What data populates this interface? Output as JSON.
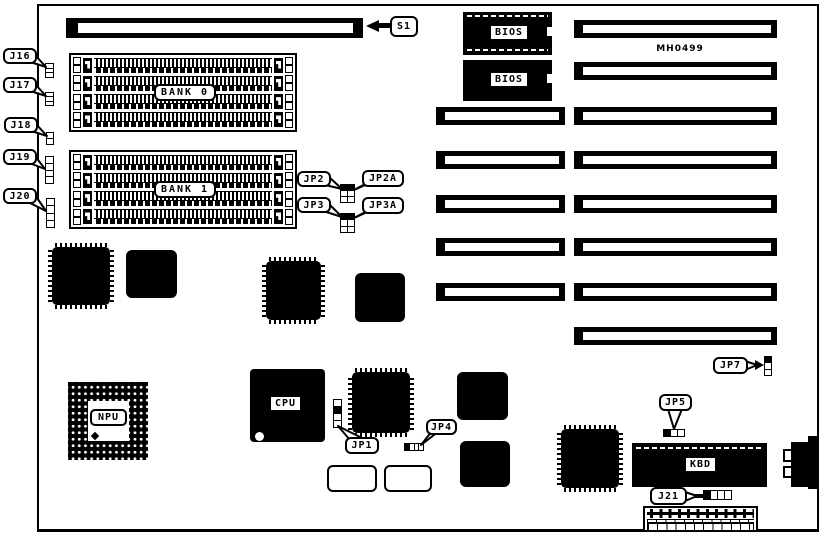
{
  "board": {
    "part_number": "MH0499",
    "colors": {
      "ink": "#000000",
      "paper": "#ffffff"
    },
    "callouts": {
      "s1": "S1",
      "j16": "J16",
      "j17": "J17",
      "j18": "J18",
      "j19": "J19",
      "j20": "J20",
      "jp1": "JP1",
      "jp2": "JP2",
      "jp2a": "JP2A",
      "jp3": "JP3",
      "jp3a": "JP3A",
      "jp4": "JP4",
      "jp5": "JP5",
      "jp7": "JP7",
      "j21": "J21"
    },
    "components": {
      "bank0": "BANK 0",
      "bank1": "BANK 1",
      "bios_top": "BIOS",
      "bios_bottom": "BIOS",
      "cpu": "CPU",
      "npu": "NPU",
      "kbd": "KBD"
    }
  }
}
